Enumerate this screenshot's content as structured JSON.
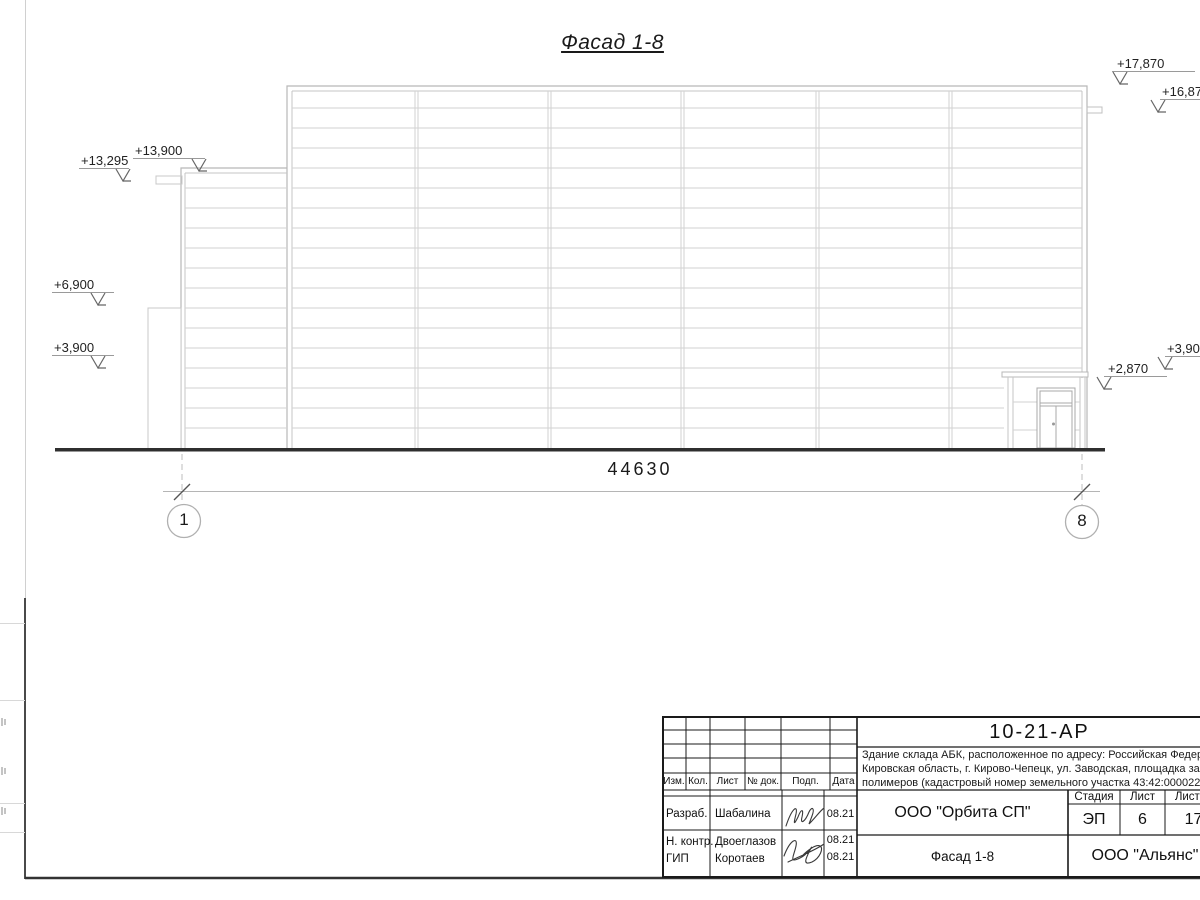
{
  "drawing": {
    "view_title": "Фасад 1-8",
    "dimension_total": "44630",
    "axis_left": "1",
    "axis_right": "8",
    "marks_left": [
      {
        "label": "+13,900"
      },
      {
        "label": "+13,295"
      },
      {
        "label": "+6,900"
      },
      {
        "label": "+3,900"
      }
    ],
    "marks_right": [
      {
        "label": "+17,870"
      },
      {
        "label": "+16,870"
      },
      {
        "label": "+3,900"
      },
      {
        "label": "+2,870"
      }
    ]
  },
  "title_block": {
    "doc_number": "10-21-АР",
    "description": [
      "Здание склада АБК, расположенное по адресу: Российская Федерац",
      "Кировская область, г. Кирово-Чепецк, ул. Заводская, площадка заво",
      "полимеров (кадастровый номер земельного участка 43:42:000022:"
    ],
    "revision_headers": [
      "Изм.",
      "Кол.",
      "Лист",
      "№ док.",
      "Подп.",
      "Дата"
    ],
    "signers": [
      {
        "role": "Разраб.",
        "name": "Шабалина",
        "date": "08.21"
      },
      {
        "role": "Н. контр.",
        "name": "Двоеглазов",
        "date": "08.21"
      },
      {
        "role": "ГИП",
        "name": "Коротаев",
        "date": "08.21"
      }
    ],
    "design_org": "ООО \"Орбита СП\"",
    "stage_label": "Стадия",
    "stage_value": "ЭП",
    "sheet_label": "Лист",
    "sheet_value": "6",
    "sheets_label": "Листов",
    "sheets_value": "17",
    "sheet_title": "Фасад 1-8",
    "org2": "ООО \"Альянс\""
  }
}
